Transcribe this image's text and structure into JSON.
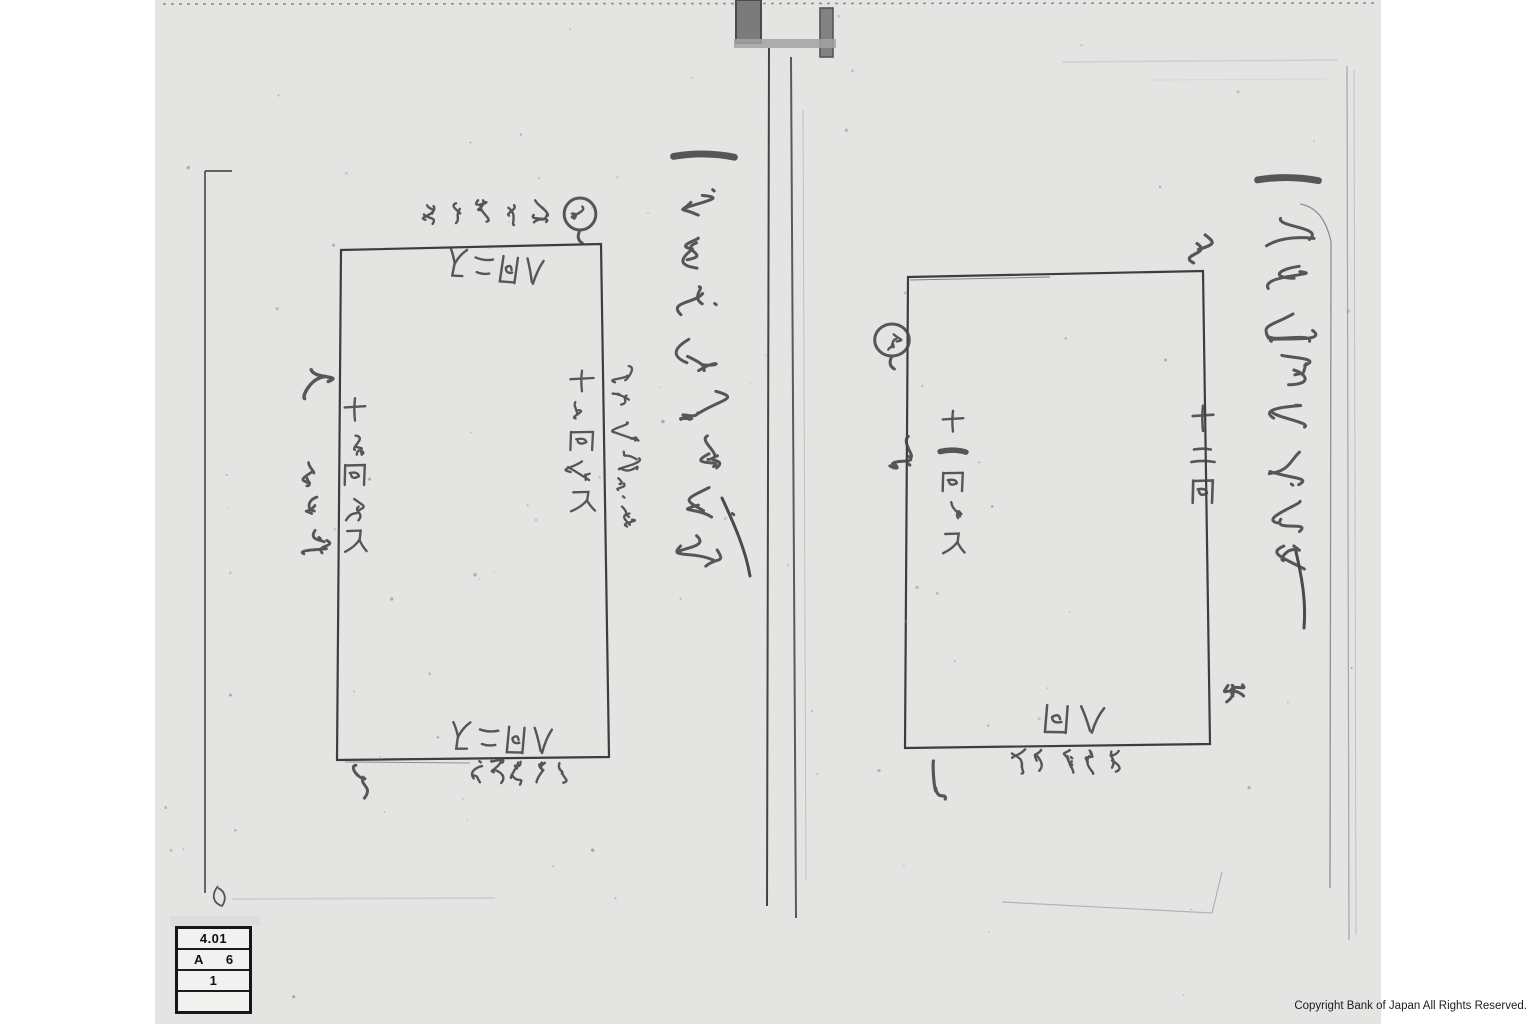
{
  "scan": {
    "copyright": "Copyright Bank of Japan All Rights Reserved.",
    "archive_label": {
      "row1": "4.01",
      "row2_left": "A",
      "row2_right": "6",
      "row3": "1",
      "row4": ""
    },
    "left_page": {
      "header": "一 宇治茶仲買五年代",
      "north_mark": "北",
      "south_mark": "南",
      "corner_seal": "印",
      "top_outside": "久吉畑限リ",
      "top_inside": "八間二尺",
      "right_outside": "中村傳藏畑先",
      "right_inside": "十九間五尺",
      "left_inside": "十七間五尺",
      "left_outside": "山口限",
      "bottom_inside": "八間二尺",
      "bottom_outside": "与五郎畑限"
    },
    "right_page": {
      "header": "一 丙申茶沖廿四五年",
      "north_mark": "北",
      "west_mark": "西",
      "east_mark": "東",
      "south_mark": "南",
      "left_outside": "畑",
      "left_inside": "十一間四尺",
      "right_inside": "十二間",
      "bottom_inside": "八間",
      "bottom_outside": "六兵衛畑限"
    }
  }
}
